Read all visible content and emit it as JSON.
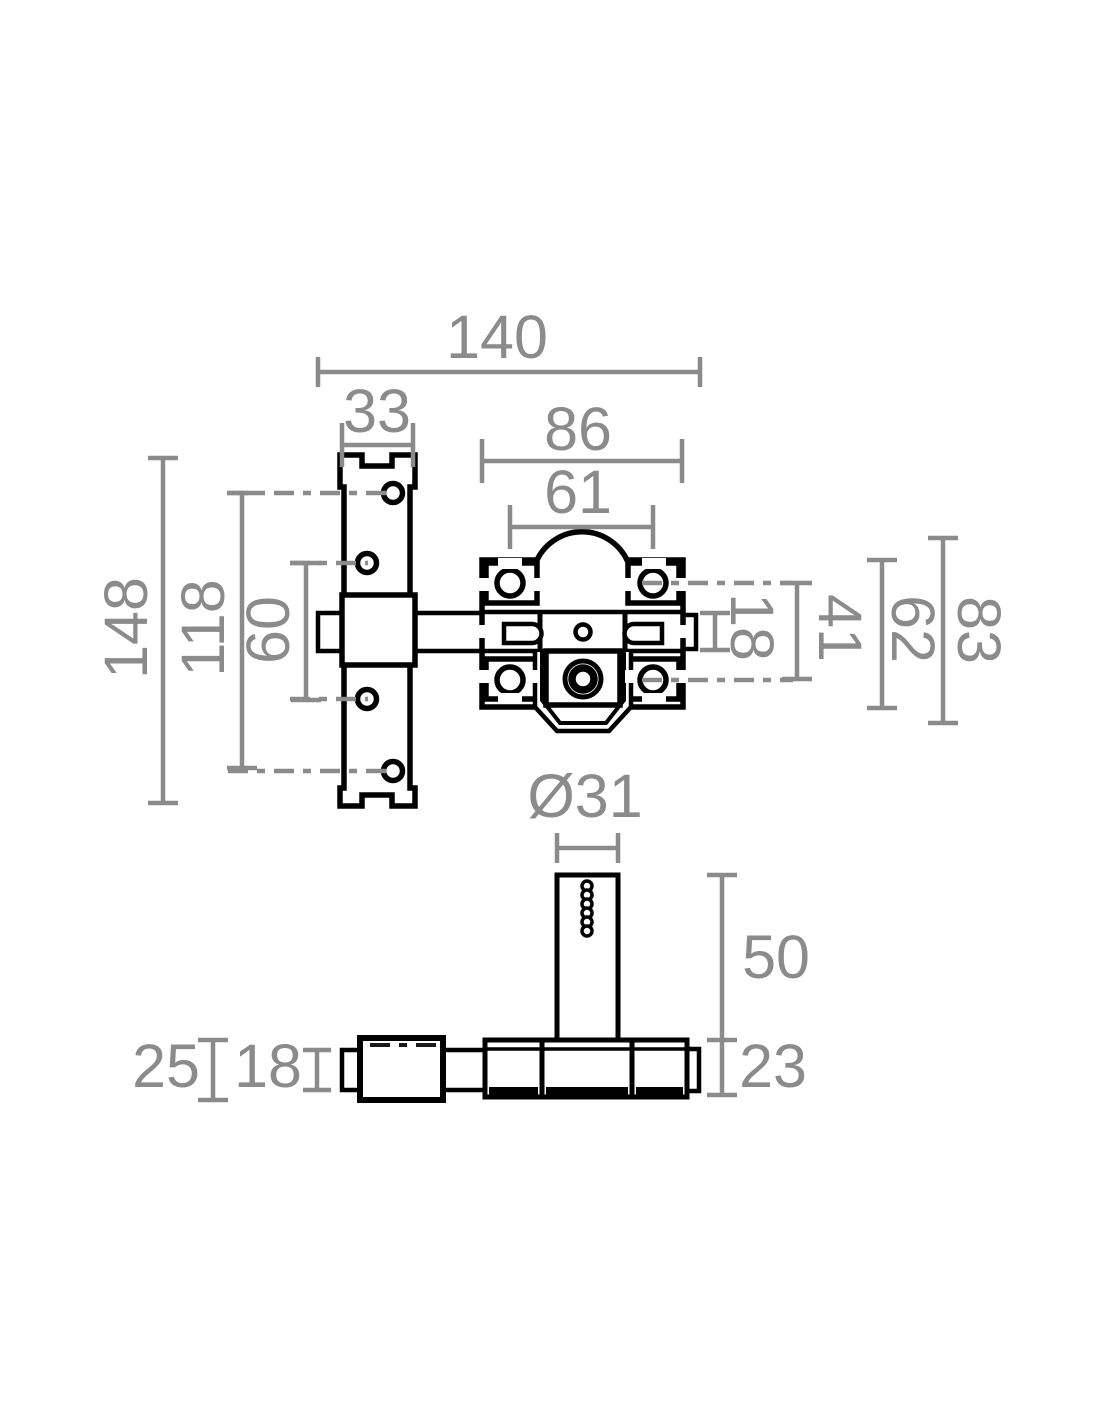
{
  "drawing": {
    "kind": "technical-drawing",
    "subject": "security door bolt lock, front view and bottom view with dimensions",
    "colors": {
      "outline": "#000000",
      "dimension": "#8b8b8b",
      "background": "#ffffff"
    },
    "front_view": {
      "dims": {
        "overall_width": "140",
        "keeper_width": "33",
        "body_width": "86",
        "arch_width": "61",
        "keeper_height": "148",
        "outer_hole_span": "118",
        "inner_hole_span": "60",
        "bolt_height": "18",
        "ear_hole_span": "41",
        "inner_height": "62",
        "overall_height": "83"
      }
    },
    "bottom_view": {
      "dims": {
        "cylinder_diameter": "Ø31",
        "cylinder_height": "50",
        "base_depth": "23",
        "keeper_depth": "25",
        "bolt_depth": "18"
      }
    }
  }
}
